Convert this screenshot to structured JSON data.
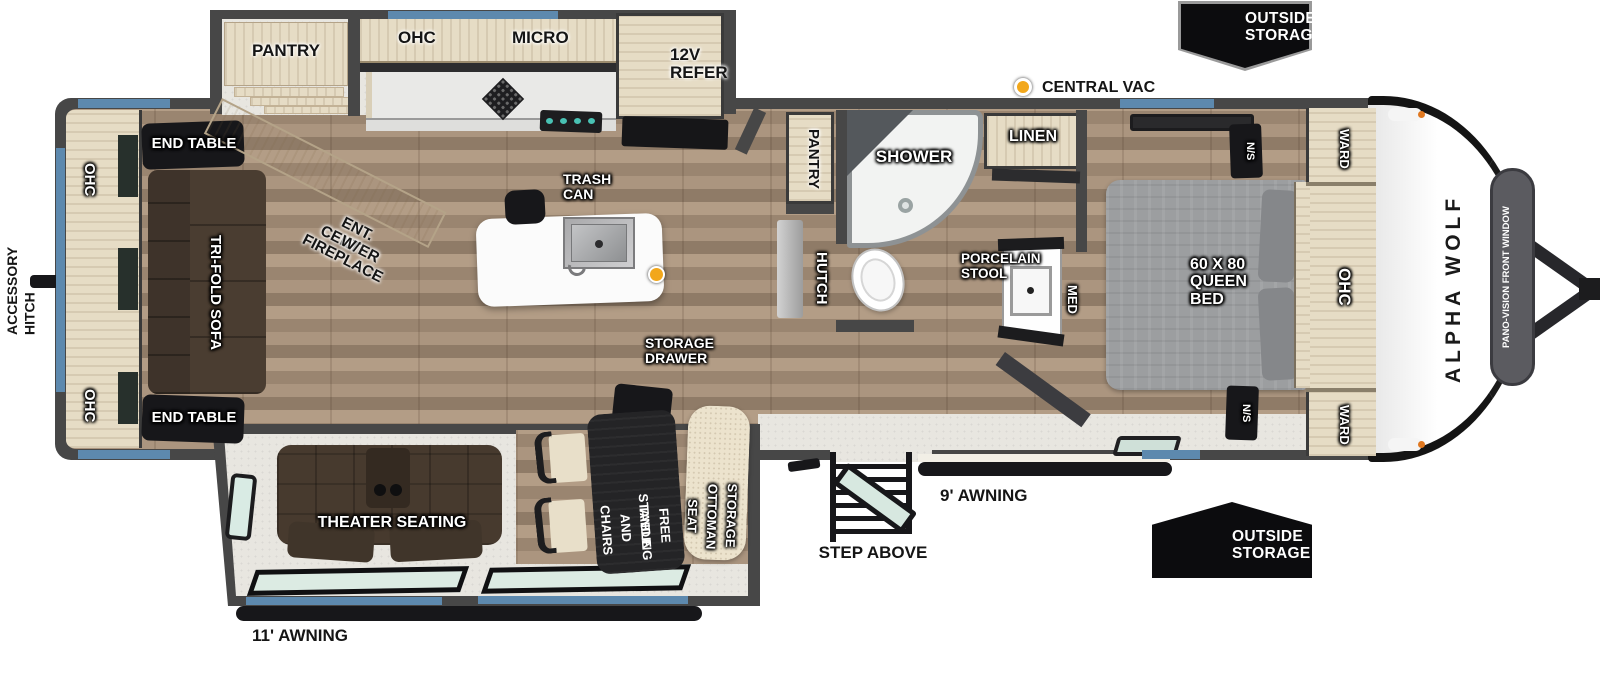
{
  "brand": {
    "name": "ALPHA WOLF",
    "front_window": "PANO-VISION FRONT WINDOW"
  },
  "exterior": {
    "front_outside_storage": [
      "OUTSIDE",
      "STORAGE"
    ],
    "door_outside_storage": [
      "OUTSIDE",
      "STORAGE"
    ],
    "central_vac": "CENTRAL VAC",
    "step_above": "STEP ABOVE",
    "awning_door_side": "9' AWNING",
    "awning_camp_side": "11' AWNING",
    "accessory_hitch": [
      "ACCESSORY",
      "HITCH"
    ]
  },
  "rear_living": {
    "ohc_top": "OHC",
    "ohc_bottom": "OHC",
    "end_table_top": "END TABLE",
    "end_table_bottom": "END TABLE",
    "sofa": "TRI-FOLD SOFA",
    "ent_center": [
      "ENT. CENTER",
      "W/ FIREPLACE"
    ]
  },
  "kitchen": {
    "pantry": "PANTRY",
    "ohc": "OHC",
    "micro": "MICRO",
    "refer": [
      "12V",
      "REFER"
    ],
    "trash_can": [
      "TRASH",
      "CAN"
    ]
  },
  "dinette": {
    "theater": "THEATER SEATING",
    "table": [
      "FREE STANDING",
      "TABLE AND CHAIRS"
    ],
    "ottoman": [
      "STORAGE",
      "OTTOMAN SEAT"
    ],
    "storage_drawer": [
      "STORAGE",
      "DRAWER"
    ]
  },
  "galley": {
    "pantry": "PANTRY",
    "hutch": "HUTCH"
  },
  "bath": {
    "shower": "SHOWER",
    "linen": "LINEN",
    "toilet": [
      "PORCELAIN",
      "STOOL"
    ],
    "med": "MED"
  },
  "bedroom": {
    "bed": [
      "60 X 80",
      "QUEEN",
      "BED"
    ],
    "ns_top": "N/S",
    "ns_bottom": "N/S",
    "ward_top": "WARD",
    "ward_bottom": "WARD",
    "ohc": "OHC"
  },
  "colors": {
    "wall": "#474747",
    "window_blue": "#5d89ae",
    "cabinet_wood": "#e6dcc5",
    "accent_orange": "#f2a71b",
    "sofa_brown": "#4a3d31",
    "bed_gray": "#9c9c9c"
  }
}
